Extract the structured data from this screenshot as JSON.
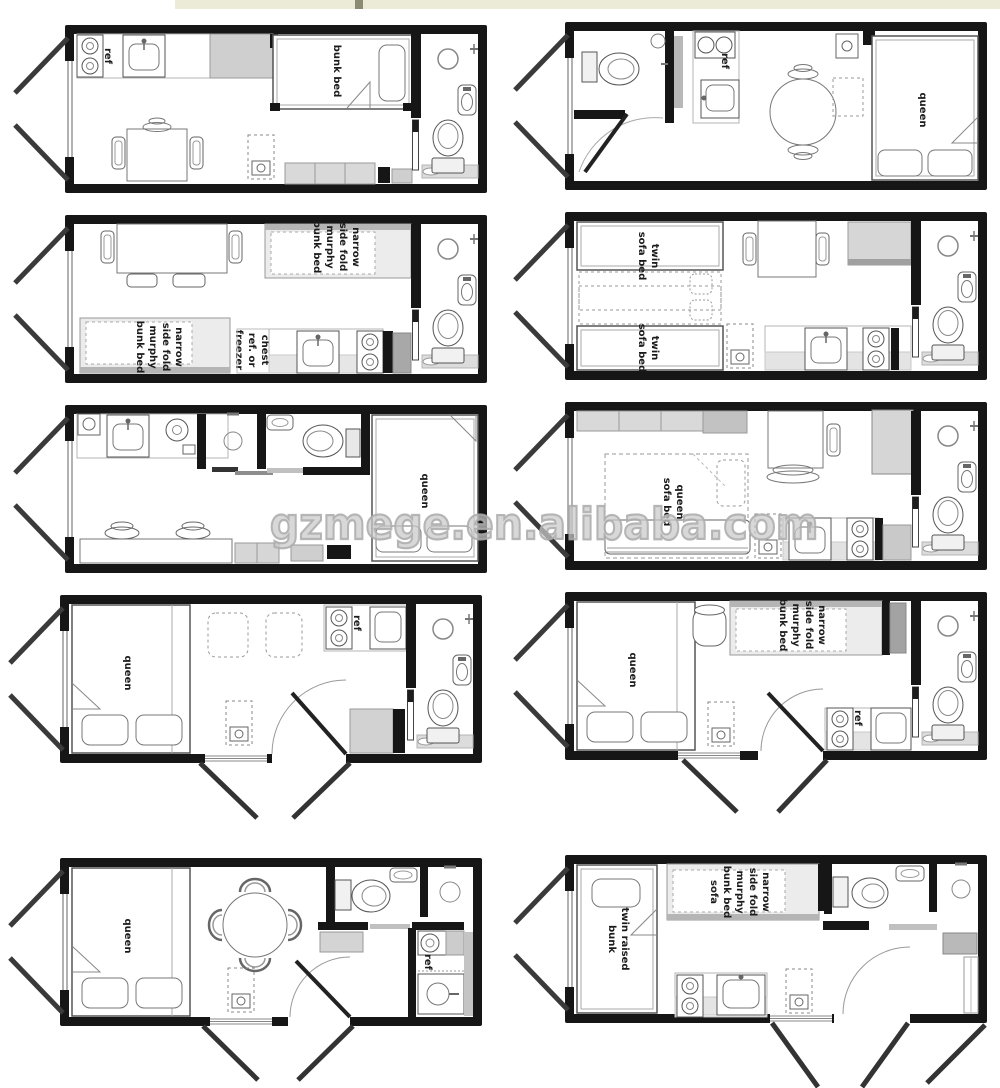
{
  "page": {
    "background": "#ffffff",
    "top_strip_color": "#ecebd8",
    "wall_color": "#161616"
  },
  "watermark": {
    "text": "gzmege.en.alibaba.com"
  },
  "plans": {
    "p1": {
      "labels": {
        "ref": "ref",
        "bunk_bed": "bunk bed"
      }
    },
    "p2": {
      "labels": {
        "ref": "ref",
        "queen": "queen"
      }
    },
    "p3": {
      "labels": {
        "murphy": [
          "narrow",
          "side fold",
          "murphy",
          "bunk bed"
        ],
        "chest": [
          "chest",
          "ref. or",
          "freezer"
        ]
      }
    },
    "p4": {
      "labels": {
        "twin": [
          "twin",
          "sofa bed"
        ]
      }
    },
    "p5": {
      "labels": {
        "queen": "queen"
      }
    },
    "p6": {
      "labels": {
        "queen_sofa": [
          "queen",
          "sofa bed"
        ]
      }
    },
    "p7": {
      "labels": {
        "queen": "queen",
        "ref": "ref"
      }
    },
    "p8": {
      "labels": {
        "queen": "queen",
        "ref": "ref",
        "murphy": [
          "narrow",
          "side fold",
          "murphy",
          "bunk bed"
        ]
      }
    },
    "p9": {
      "labels": {
        "queen": "queen",
        "ref": "ref"
      }
    },
    "p10": {
      "labels": {
        "twin": [
          "twin raised",
          "bunk"
        ],
        "murphy": [
          "narrow",
          "side fold",
          "murphy",
          "bunk bed",
          "sofa"
        ]
      }
    }
  }
}
